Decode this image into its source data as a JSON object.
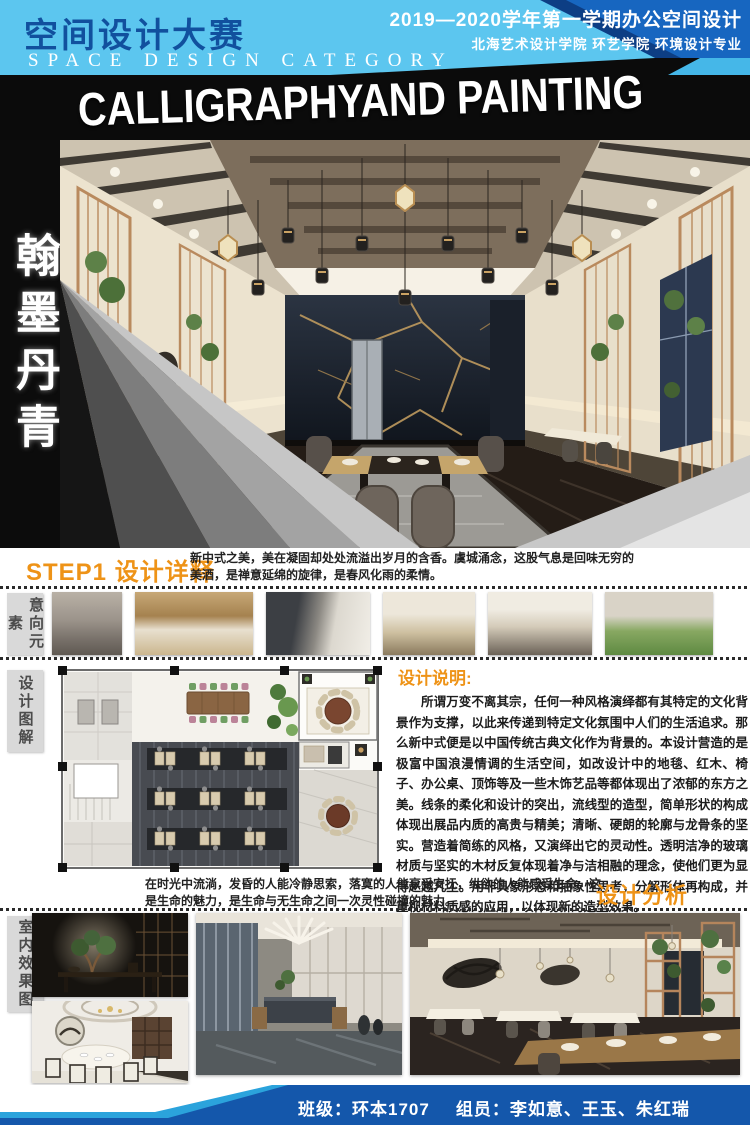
{
  "header": {
    "title_cn": "空间设计大赛",
    "title_en": "SPACE DESIGN CATEGORY",
    "term_line": "2019—2020学年第一学期办公空间设计",
    "school_line": "北海艺术设计学院  环艺学院  环境设计专业"
  },
  "banner": {
    "title": "CALLIGRAPHYAND PAINTING"
  },
  "hero": {
    "vertical_title": "翰墨丹青"
  },
  "sections": {
    "step1": {
      "heading": "STEP1 设计详释",
      "intro": "新中式之美，美在凝固却处处流溢出岁月的含香。虞城涌念，这股气息是回味无穷的美酒，是禅意延绵的旋律，是春风化雨的柔情。"
    },
    "intent_label": "意向元素",
    "diagram_label": "设计图解",
    "render_label": "室内效果图",
    "design_note": {
      "heading": "设计说明:",
      "body": "所谓万变不离其宗，任何一种风格演绎都有其特定的文化背景作为支撑，以此来传递到特定文化氛围中人们的生活追求。那么新中式便是以中国传统古典文化作为背景的。本设计营造的是极富中国浪漫情调的生活空间，如改设计中的地毯、红木、椅子、办公桌、顶饰等及一些木饰艺品等都体现出了浓郁的东方之美。线条的柔化和设计的突出，流线型的造型，简单形状的构成体现出展品内质的高贵与精美；清晰、硬朗的轮廓与龙骨条的坚实。营造着简练的风格，又演绎出它的灵动性。透明洁净的玻璃材质与坚实的木材反复体现着净与洁相融的理念，使他们更为显得赵越凡尘。用非具象形态和抽象性思考，分解形体再构成，并重视材料质感的应用，以体现新的造型效果。"
    },
    "step2": {
      "heading": "设计分析  STEP2",
      "intro": "在时光中流淌，发昏的人能冷静思索，落寞的人能享受安抚，纵欲的人能感受生命。这是生命的魅力，是生命与无生命之间一次灵性碰撞的魅力。"
    }
  },
  "footer": {
    "class_info": "班级：环本1707",
    "members": "组员：李如意、王玉、朱红瑞"
  },
  "colors": {
    "accent_orange": "#ee9317",
    "header_blue": "#1766c0",
    "header_light_blue": "#5cc6ef",
    "footer_blue": "#1457ab",
    "footer_light_blue": "#2ba3dc"
  }
}
